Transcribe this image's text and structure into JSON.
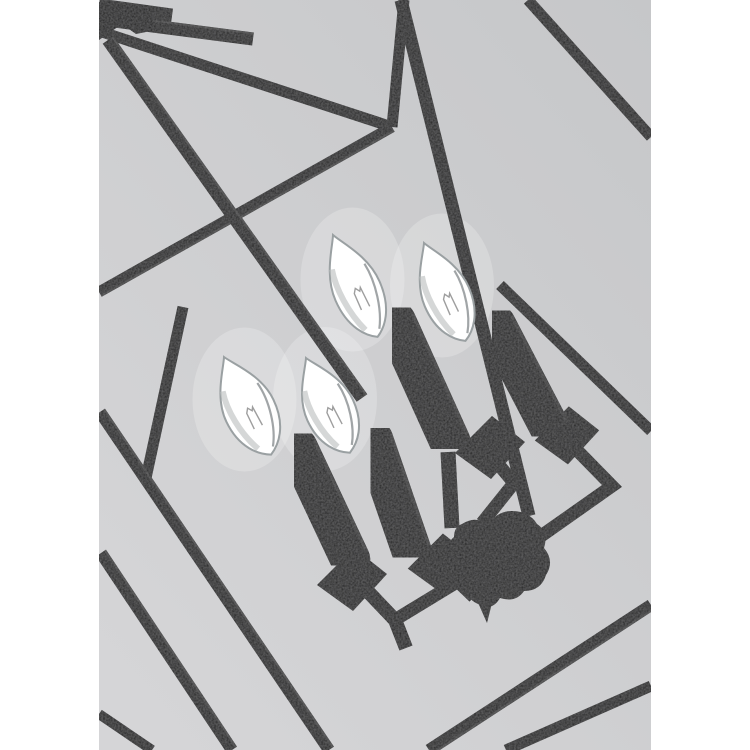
{
  "photo": {
    "canvas_w": 750,
    "canvas_h": 750,
    "margin_color": "#ffffff",
    "photo_x": 99,
    "photo_w": 552,
    "bg_top": "#c6c7c9",
    "bg_bottom": "#d5d5d7",
    "metal": "#1d1d1d",
    "metal_dark": "#141414",
    "metal_edge": "#4a4a4a",
    "bulb_fill": "#ffffff",
    "bulb_mid": "#f1f2f2",
    "bulb_outline": "#9aa0a2",
    "bulb_shade": "#b9bcbc",
    "filament": "#8d8d8d",
    "glow": "#ffffff"
  },
  "frame_bars": [
    {
      "name": "top-rim-stub-upper",
      "p": [
        99,
        6,
        172,
        16
      ],
      "w": 15
    },
    {
      "name": "top-rim-stub",
      "p": [
        99,
        19,
        253,
        39
      ],
      "w": 13,
      "hl": true
    },
    {
      "name": "top-rim-left",
      "p": [
        99,
        31,
        392,
        127
      ],
      "w": 11
    },
    {
      "name": "top-post",
      "p": [
        404,
        0,
        392,
        127
      ],
      "w": 11
    },
    {
      "name": "rim-junction-downleft",
      "p": [
        392,
        127,
        99,
        292
      ],
      "w": 11,
      "hl": true
    },
    {
      "name": "diagonal-left-brace",
      "p": [
        108,
        40,
        362,
        398
      ],
      "w": 13,
      "hl": true
    },
    {
      "name": "top-right-brace",
      "p": [
        528,
        0,
        651,
        137
      ],
      "w": 11
    },
    {
      "name": "right-mid-brace",
      "p": [
        500,
        285,
        651,
        431
      ],
      "w": 11
    },
    {
      "name": "left-short-post",
      "p": [
        183,
        307,
        146,
        478
      ],
      "w": 11
    },
    {
      "name": "bottom-left-rail-1",
      "p": [
        100,
        412,
        329,
        750
      ],
      "w": 12,
      "hl": true
    },
    {
      "name": "bottom-left-rail-2",
      "p": [
        101,
        553,
        232,
        750
      ],
      "w": 12,
      "hl": true
    },
    {
      "name": "bottom-left-corner-bar",
      "p": [
        99,
        714,
        152,
        750
      ],
      "w": 10
    },
    {
      "name": "bottom-right-rail-1",
      "p": [
        651,
        605,
        429,
        750
      ],
      "w": 12,
      "hl": true
    },
    {
      "name": "bottom-right-rail-2",
      "p": [
        651,
        686,
        506,
        750
      ],
      "w": 11
    },
    {
      "name": "center-downrod",
      "p": [
        401,
        0,
        529,
        516
      ],
      "w": 13
    }
  ],
  "plates": [
    {
      "name": "bobeche-back-left",
      "cx": 490,
      "cy": 446,
      "s": 1.0
    },
    {
      "name": "bobeche-back-right",
      "cx": 567,
      "cy": 434,
      "s": 0.92
    },
    {
      "name": "bobeche-front-left",
      "cx": 352,
      "cy": 578,
      "s": 1.0
    },
    {
      "name": "bobeche-front-right",
      "cx": 441,
      "cy": 562,
      "s": 0.95
    }
  ],
  "arms": [
    {
      "name": "arm-back-left-drop",
      "pts": [
        [
          448,
          452
        ],
        [
          452,
          528
        ]
      ],
      "w": 15
    },
    {
      "name": "arm-back-left-elbow",
      "pts": [
        [
          488,
          452
        ],
        [
          514,
          483
        ],
        [
          482,
          523
        ]
      ],
      "w": 13
    },
    {
      "name": "arm-back-right-elbow",
      "pts": [
        [
          567,
          440
        ],
        [
          612,
          486
        ],
        [
          541,
          536
        ]
      ],
      "w": 13
    },
    {
      "name": "arm-front-left-drop",
      "pts": [
        [
          357,
          580
        ],
        [
          395,
          620
        ],
        [
          406,
          648
        ]
      ],
      "w": 14
    },
    {
      "name": "arm-front-left-return",
      "pts": [
        [
          393,
          621
        ],
        [
          467,
          576
        ]
      ],
      "w": 13
    },
    {
      "name": "arm-front-right-drop",
      "pts": [
        [
          447,
          571
        ],
        [
          474,
          597
        ]
      ],
      "w": 13
    }
  ],
  "hub": {
    "name": "center-hub",
    "cx": 497,
    "cy": 560
  },
  "candles": [
    {
      "name": "candle-back-left",
      "tip": [
        333,
        235
      ],
      "base": [
        372,
        324
      ],
      "bw": 48,
      "st": [
        394,
        318
      ],
      "sb": [
        452,
        446
      ],
      "sw": 41
    },
    {
      "name": "candle-back-right",
      "tip": [
        424,
        243
      ],
      "base": [
        460,
        328
      ],
      "bw": 48,
      "st": [
        494,
        321
      ],
      "sb": [
        553,
        434
      ],
      "sw": 40
    },
    {
      "name": "candle-front-left",
      "tip": [
        224,
        357
      ],
      "base": [
        265,
        442
      ],
      "bw": 52,
      "st": [
        296,
        444
      ],
      "sb": [
        352,
        563
      ],
      "sw": 40
    },
    {
      "name": "candle-front-right",
      "tip": [
        306,
        358
      ],
      "base": [
        344,
        440
      ],
      "bw": 50,
      "st": [
        372,
        436
      ],
      "sb": [
        413,
        555
      ],
      "sw": 40
    }
  ]
}
